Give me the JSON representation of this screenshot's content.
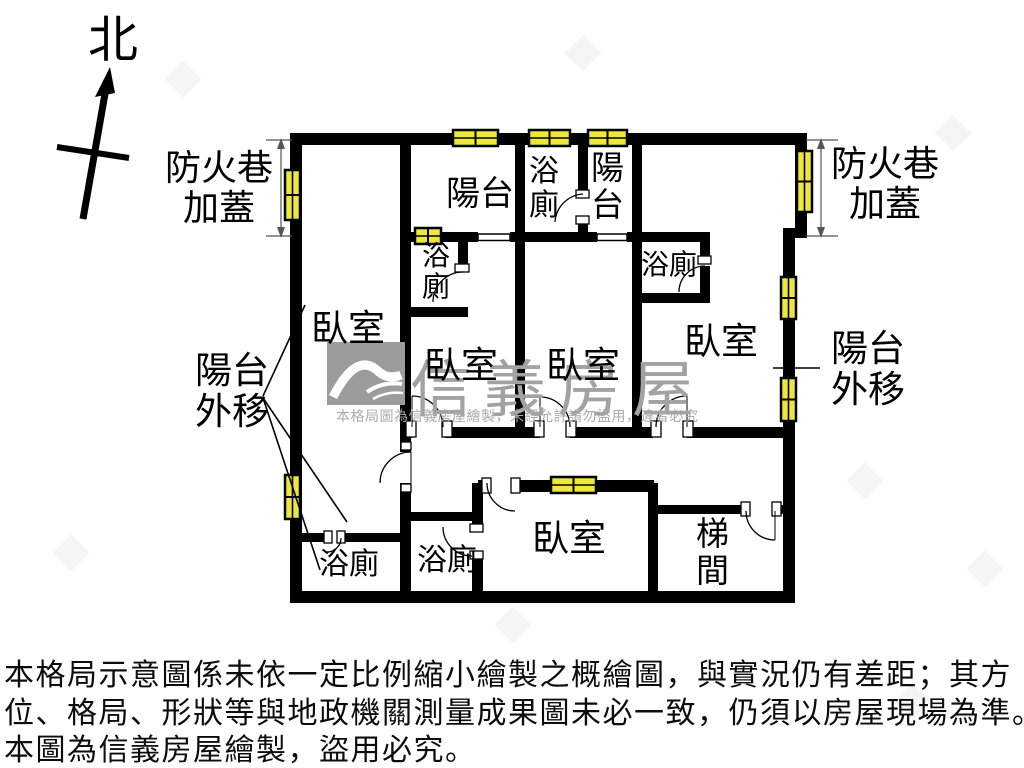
{
  "colors": {
    "wall": "#000000",
    "window_fill": "#ece73a",
    "watermark_gray": "#a2a2a2"
  },
  "compass": {
    "label": "北"
  },
  "dimensions": {
    "fire_lane_left": "防火巷\n加蓋",
    "fire_lane_right": "防火巷\n加蓋"
  },
  "rooms": {
    "balcony_top": "陽台",
    "bath_top": "浴\n廁",
    "balcony_top_right": "陽\n台",
    "bath_small": "浴\n廁",
    "bath_bedroom4": "浴廁",
    "bedroom1": "臥室",
    "bedroom2": "臥室",
    "bedroom3": "臥室",
    "bedroom4": "臥室",
    "bedroom_bottom": "臥室",
    "balcony_moved_left": "陽台\n外移",
    "balcony_moved_right": "陽台\n外移",
    "bath_bottom_left": "浴廁",
    "bath_bottom_mid": "浴廁",
    "stairwell": "梯\n間"
  },
  "watermark": {
    "brand": "信義房屋",
    "notice": "本格局圖為信義房屋繪製，未經允許請勿盜用，違者必究"
  },
  "disclaimer": {
    "line1": "本格局示意圖係未依一定比例縮小繪製之概繪圖，與實況仍有差距；其方",
    "line2": "位、格局、形狀等與地政機關測量成果圖未必一致，仍須以房屋現場為準。",
    "line3": "本圖為信義房屋繪製，盜用必究。"
  }
}
